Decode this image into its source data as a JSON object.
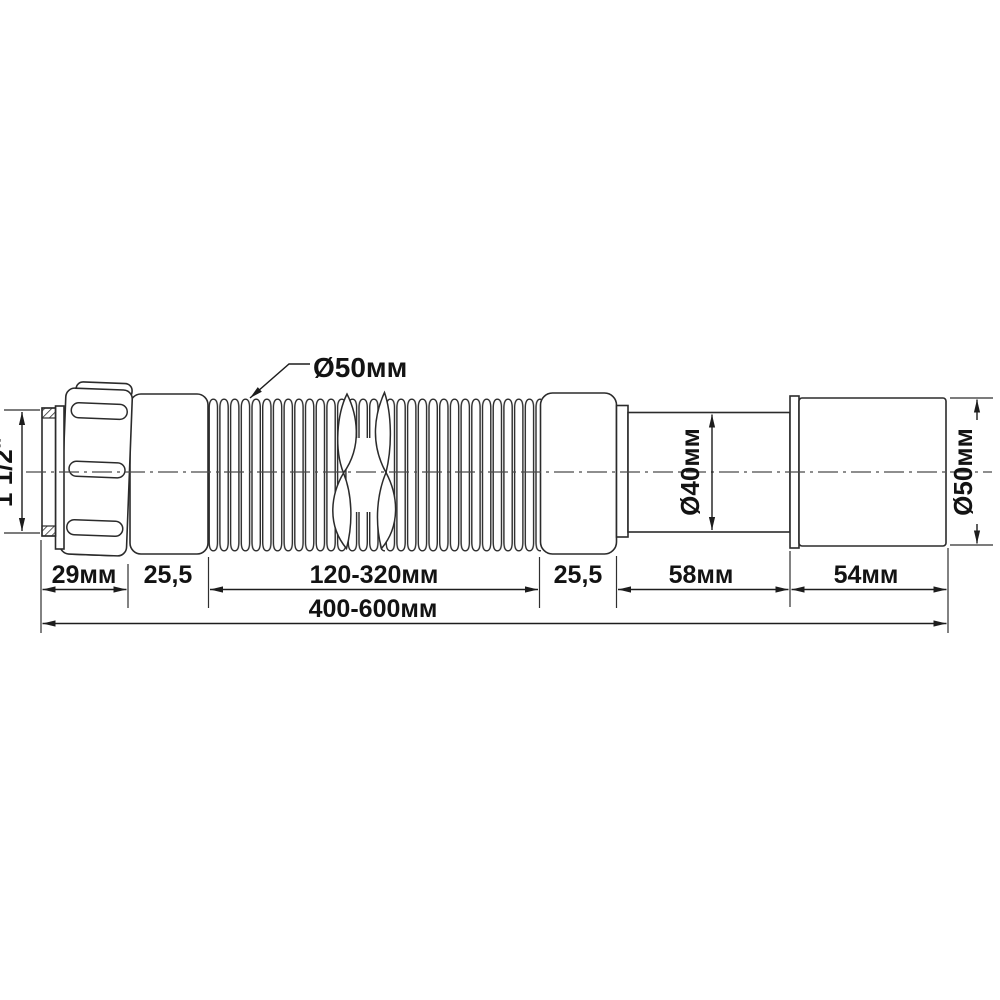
{
  "drawing": {
    "labels": {
      "thread": "1 1/2\"",
      "hose_dia": "Ø50мм",
      "outlet_dia": "Ø40мм",
      "end_dia": "Ø50мм"
    },
    "dims": {
      "nut": "29мм",
      "left_collar": "25,5",
      "hose": "120-320мм",
      "right_collar": "25,5",
      "outlet": "58мм",
      "end": "54мм",
      "overall": "400-600мм"
    }
  }
}
